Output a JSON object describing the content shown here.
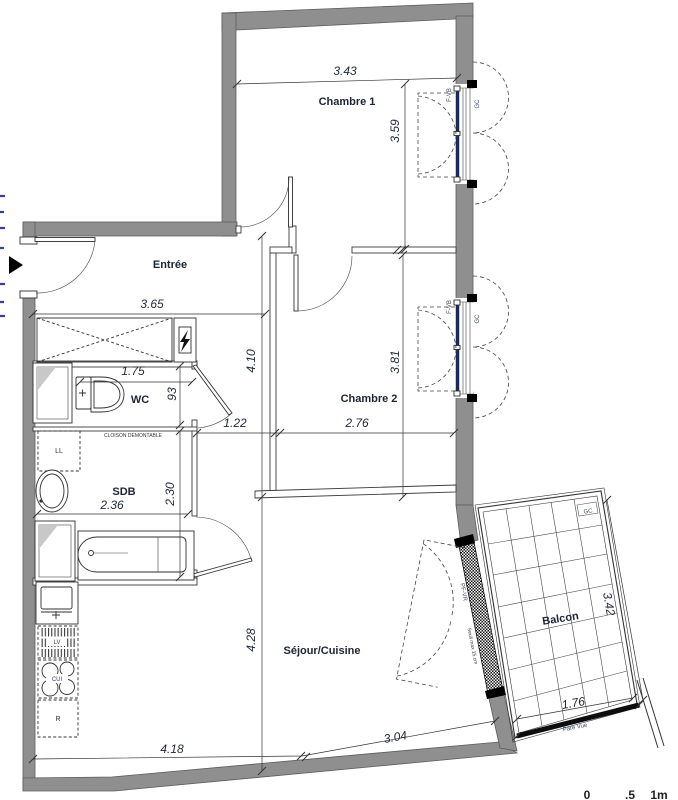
{
  "rooms": {
    "chambre1": "Chambre 1",
    "chambre2": "Chambre 2",
    "entree": "Entrée",
    "wc": "WC",
    "sdb": "SDB",
    "sejour": "Séjour/Cuisine",
    "balcon": "Balcon"
  },
  "dims": {
    "ch1_w": "3.43",
    "ch1_h": "3.59",
    "entree_w": "3.65",
    "wc_w": "1.75",
    "wc_h": "93",
    "hall_w": "1.22",
    "ch2_w": "2.76",
    "hall_h": "4.10",
    "ch2_h": "3.81",
    "sdb_w": "2.36",
    "sdb_h": "2.30",
    "sejour_h": "4.28",
    "sejour_w1": "4.18",
    "sejour_w2": "3.04",
    "balcon_w": "1.76",
    "balcon_h": "3.42"
  },
  "labels": {
    "cloison": "CLOISON DEMONTABLE",
    "pare_vue": "Pare Vue",
    "pf_vr": "PF-VR",
    "seuil": "Seuil max 15 cm",
    "f_vb": "F-VB",
    "gc": "GC",
    "ll": "LL",
    "lv": "LV",
    "cui": "CUI",
    "r": "R"
  },
  "scale_bar": {
    "zero": "0",
    "half": ".5",
    "one": "1m"
  },
  "colors": {
    "wall": "#8f8f8f",
    "glass": "#1c2b66",
    "text": "#1d2433"
  }
}
